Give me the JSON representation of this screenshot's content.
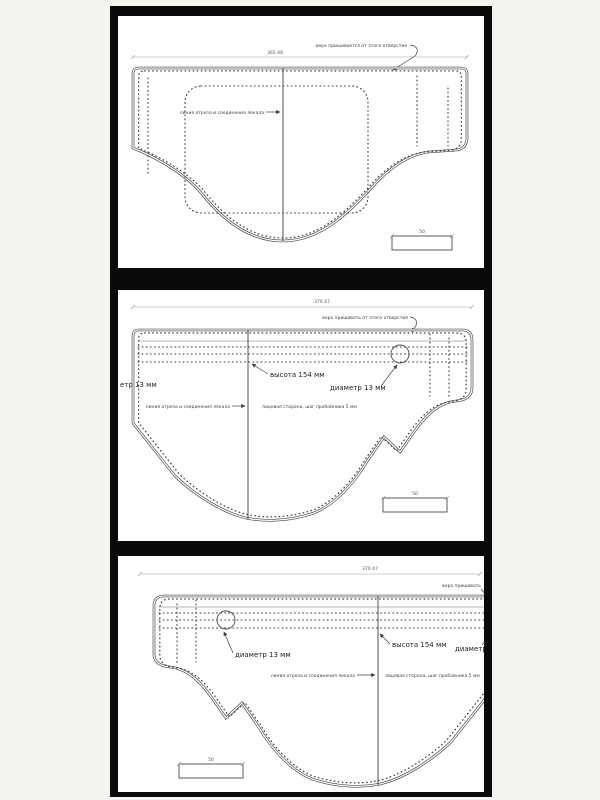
{
  "colors": {
    "background": "#f4f3ee",
    "backdrop": "#0a0a0a",
    "paper": "#ffffff",
    "ink": "#3f3f3f",
    "dim_line": "#9a9a9a"
  },
  "panels": [
    {
      "name": "top pattern sheet",
      "dimension": "365.48",
      "note_attach": "верх пришивается от этого отверстия",
      "note_cutline": "линия отреза и соединения лекала",
      "small_dim": "50"
    },
    {
      "name": "middle pattern sheet",
      "dimension": "370.47",
      "note_attach": "верх пришивать от этого отверстия",
      "label_height": "высота 154 мм",
      "label_diameter": "диаметр 13 мм",
      "label_diameter_left_cut": "етр 13 мм",
      "note_cutline": "линия отреза и соединения лекала",
      "note_face": "лицевая сторона, шаг пробойника 5 мм",
      "small_dim": "50"
    },
    {
      "name": "bottom pattern sheet",
      "dimension": "370.47",
      "note_attach_cut": "верх пришивать",
      "label_height": "высота 154 мм",
      "label_diameter": "диаметр 13 мм",
      "label_diameter_right_cut": "диаметр",
      "note_cutline": "линия отреза и соединения лекала",
      "note_face": "лицевая сторона, шаг пробойника 5 мм",
      "small_dim": "50"
    }
  ]
}
